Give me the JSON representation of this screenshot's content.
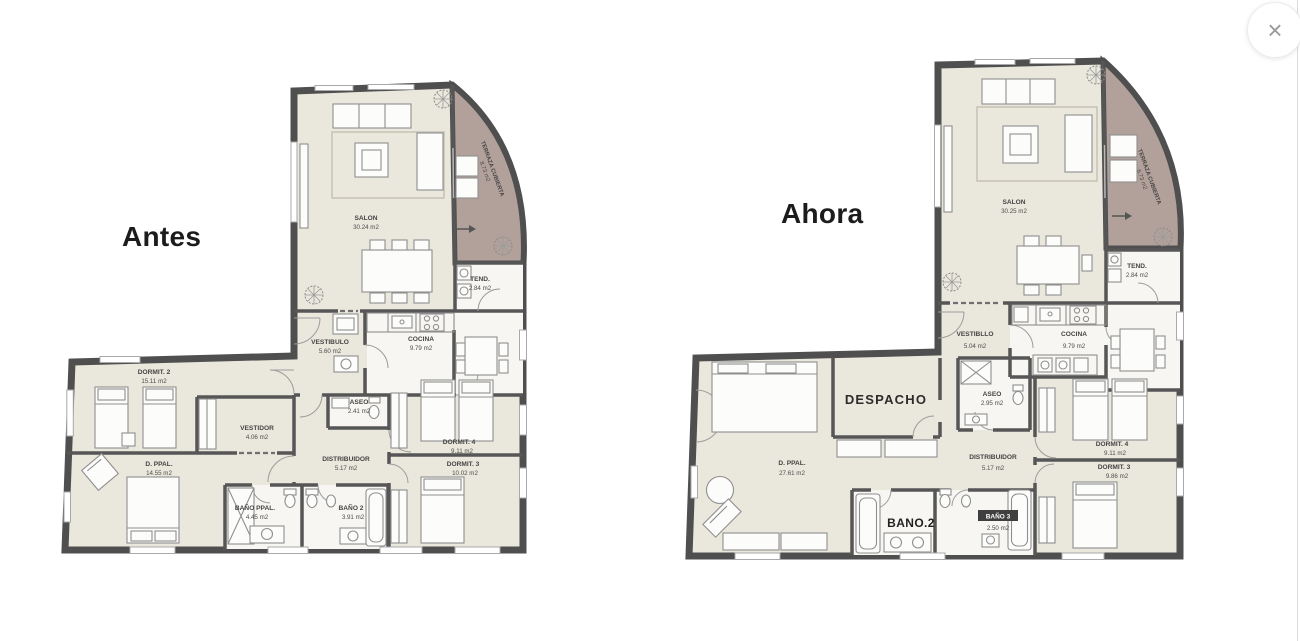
{
  "ui": {
    "close_icon": "×"
  },
  "colors": {
    "wall": "#4f4f4f",
    "floor": "#eae7dc",
    "terrace": "#b2a19a",
    "wet_floor": "#f7f6f2",
    "title_text": "#1c1c1c"
  },
  "plans": {
    "antes": {
      "title": "Antes",
      "rooms": {
        "salon": {
          "name": "SALON",
          "area": "30.24 m2"
        },
        "terraza": {
          "name": "TERRAZA CUBIERTA",
          "area": "8.73 m2"
        },
        "tend": {
          "name": "TEND.",
          "area": "2.84 m2"
        },
        "vestibulo": {
          "name": "VESTIBULO",
          "area": "5.60 m2"
        },
        "cocina": {
          "name": "COCINA",
          "area": "9.79 m2"
        },
        "aseo": {
          "name": "ASEO",
          "area": "2.41 m2"
        },
        "dormit2": {
          "name": "DORMIT. 2",
          "area": "15.11 m2"
        },
        "vestidor": {
          "name": "VESTIDOR",
          "area": "4.06 m2"
        },
        "dppal": {
          "name": "D. PPAL.",
          "area": "14.55 m2"
        },
        "distribuidor": {
          "name": "DISTRIBUIDOR",
          "area": "5.17 m2"
        },
        "dormit4": {
          "name": "DORMIT. 4",
          "area": "9.11 m2"
        },
        "dormit3": {
          "name": "DORMIT. 3",
          "area": "10.02 m2"
        },
        "bano_ppal": {
          "name": "BAÑO PPAL.",
          "area": "4.45 m2"
        },
        "bano2": {
          "name": "BAÑO 2",
          "area": "3.91 m2"
        }
      }
    },
    "ahora": {
      "title": "Ahora",
      "rooms": {
        "salon": {
          "name": "SALON",
          "area": "30.25 m2"
        },
        "terraza": {
          "name": "TERRAZA CUBIERTA",
          "area": "6.73 m2"
        },
        "tend": {
          "name": "TEND.",
          "area": "2.84 m2"
        },
        "vestibulo": {
          "name": "VESTIBLLO",
          "area": "5.04 m2"
        },
        "cocina": {
          "name": "COCINA",
          "area": "9.79 m2"
        },
        "aseo": {
          "name": "ASEO",
          "area": "2.95 m2"
        },
        "dppal": {
          "name": "D. PPAL.",
          "area": "27.61 m2"
        },
        "despacho": {
          "name": "DESPACHO"
        },
        "distribuidor": {
          "name": "DISTRIBUIDOR",
          "area": "5.17 m2"
        },
        "dormit4": {
          "name": "DORMIT. 4",
          "area": "9.11 m2"
        },
        "dormit3": {
          "name": "DORMIT. 3",
          "area": "9.86 m2"
        },
        "bano2": {
          "name": "BANO.2"
        },
        "bano3": {
          "name": "BAÑO 3",
          "area": "2.50 m2"
        }
      }
    }
  }
}
